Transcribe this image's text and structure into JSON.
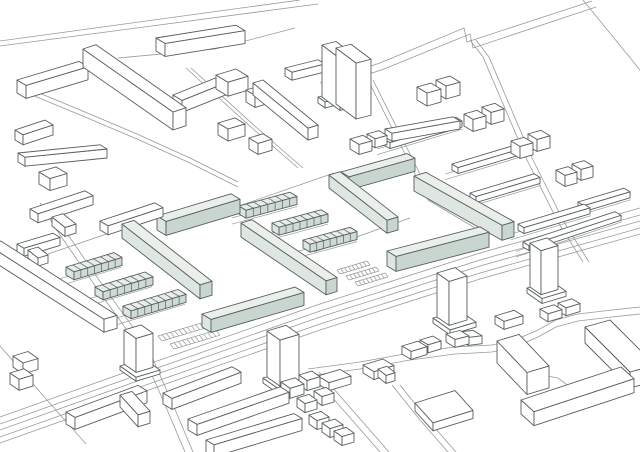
{
  "figure": {
    "kind": "axonometric-site-plan",
    "highlight_meaning": "proposed-buildings"
  },
  "palette": {
    "background": "#ffffff",
    "building_line": "#585e60",
    "road_line": "#969b9b",
    "white_face": "#ffffff",
    "green_top": "#eaefea",
    "green_end": "#dde6e0",
    "green_front": "#c9d6cf",
    "row_top": "#e8ede9",
    "row_end": "#dce5df",
    "row_front": "#cfdad3"
  },
  "scene": {
    "boxes": [
      [
        156,
        51,
        80,
        -0.16,
        9,
        0.6,
        13,
        "w"
      ],
      [
        83,
        67,
        13,
        -0.33,
        90,
        0.7,
        18,
        "w"
      ],
      [
        173,
        107,
        57,
        -0.4,
        9,
        0.6,
        12,
        "w"
      ],
      [
        216,
        89,
        20,
        -0.3,
        12,
        0.6,
        14,
        "w"
      ],
      [
        218,
        135,
        17,
        -0.3,
        10,
        0.6,
        12,
        "w"
      ],
      [
        246,
        102,
        15,
        -0.3,
        9,
        0.6,
        12,
        "w"
      ],
      [
        249,
        149,
        14,
        -0.3,
        9,
        0.6,
        11,
        "w"
      ],
      [
        253,
        95,
        10,
        -0.3,
        55,
        0.82,
        12,
        "w"
      ],
      [
        285,
        76,
        33,
        -0.25,
        7,
        0.6,
        8,
        "w"
      ],
      [
        318,
        103,
        8,
        -0.25,
        7,
        0.7,
        6,
        "w"
      ],
      [
        322,
        97,
        14,
        -0.25,
        18,
        0.75,
        52,
        "w"
      ],
      [
        336,
        104,
        15,
        -0.25,
        20,
        0.75,
        56,
        "w"
      ],
      [
        17,
        93,
        62,
        -0.3,
        9,
        0.6,
        13,
        "w"
      ],
      [
        15,
        140,
        30,
        -0.33,
        8,
        0.6,
        10,
        "w"
      ],
      [
        18,
        162,
        82,
        -0.1,
        7,
        0.6,
        9,
        "w"
      ],
      [
        39,
        184,
        17,
        -0.3,
        11,
        0.6,
        12,
        "w"
      ],
      [
        30,
        218,
        55,
        -0.33,
        8,
        0.6,
        9,
        "w"
      ],
      [
        52,
        226,
        11,
        -0.3,
        13,
        0.8,
        9,
        "w"
      ],
      [
        100,
        230,
        55,
        -0.33,
        8,
        0.6,
        9,
        "w"
      ],
      [
        124,
        238,
        11,
        -0.3,
        13,
        0.8,
        9,
        "w"
      ],
      [
        17,
        252,
        36,
        -0.3,
        7,
        0.6,
        8,
        "w"
      ],
      [
        28,
        258,
        10,
        -0.3,
        10,
        0.8,
        8,
        "w"
      ],
      [
        -12,
        258,
        13,
        -0.3,
        116,
        0.64,
        13,
        "w"
      ],
      [
        66,
        275,
        48,
        -0.3,
        8,
        0.6,
        8,
        "r",
        7,
        1
      ],
      [
        95,
        295,
        50,
        -0.3,
        8,
        0.6,
        8,
        "r",
        7,
        1
      ],
      [
        123,
        314,
        55,
        -0.3,
        8,
        0.6,
        8,
        "r",
        8,
        1
      ],
      [
        157,
        230,
        74,
        -0.3,
        9,
        0.6,
        14,
        "g"
      ],
      [
        122,
        238,
        12,
        -0.3,
        78,
        0.78,
        14,
        "g"
      ],
      [
        202,
        327,
        93,
        -0.29,
        9,
        0.6,
        13,
        "g"
      ],
      [
        241,
        237,
        11,
        -0.3,
        85,
        0.68,
        14,
        "g"
      ],
      [
        239,
        214,
        51,
        -0.27,
        7,
        0.6,
        8,
        "r",
        7,
        1
      ],
      [
        272,
        231,
        49,
        -0.27,
        7,
        0.6,
        8,
        "r",
        7,
        1
      ],
      [
        303,
        248,
        47,
        -0.27,
        7,
        0.6,
        8,
        "r",
        7,
        1
      ],
      [
        341,
        185,
        66,
        -0.28,
        8,
        0.6,
        13,
        "g"
      ],
      [
        329,
        188,
        11,
        -0.3,
        58,
        0.78,
        13,
        "g"
      ],
      [
        414,
        191,
        12,
        -0.3,
        88,
        0.56,
        15,
        "g"
      ],
      [
        387,
        266,
        93,
        -0.26,
        9,
        0.6,
        15,
        "g"
      ],
      [
        350,
        149,
        13,
        -0.28,
        9,
        0.6,
        10,
        "w"
      ],
      [
        367,
        143,
        12,
        -0.28,
        8,
        0.6,
        9,
        "w"
      ],
      [
        384,
        145,
        72,
        -0.3,
        6,
        0.6,
        6,
        "w",
        0,
        1
      ],
      [
        417,
        100,
        14,
        -0.28,
        10,
        0.6,
        13,
        "w"
      ],
      [
        436,
        93,
        14,
        -0.28,
        10,
        0.6,
        13,
        "w"
      ],
      [
        452,
        170,
        66,
        -0.3,
        6,
        0.6,
        6,
        "w",
        0,
        1
      ],
      [
        464,
        126,
        13,
        -0.28,
        9,
        0.6,
        12,
        "w"
      ],
      [
        482,
        119,
        13,
        -0.28,
        9,
        0.6,
        12,
        "w"
      ],
      [
        470,
        199,
        64,
        -0.3,
        6,
        0.6,
        6,
        "w",
        0,
        1
      ],
      [
        511,
        153,
        13,
        -0.28,
        9,
        0.6,
        12,
        "w"
      ],
      [
        528,
        146,
        13,
        -0.28,
        9,
        0.6,
        12,
        "w"
      ],
      [
        518,
        230,
        66,
        -0.3,
        6,
        0.6,
        6,
        "w",
        0,
        1
      ],
      [
        556,
        181,
        12,
        -0.28,
        9,
        0.6,
        11,
        "w"
      ],
      [
        572,
        175,
        12,
        -0.28,
        9,
        0.6,
        11,
        "w"
      ],
      [
        578,
        208,
        46,
        -0.3,
        6,
        0.6,
        6,
        "w",
        0,
        1
      ],
      [
        523,
        247,
        92,
        -0.33,
        6,
        0.6,
        5,
        "w",
        0,
        1
      ],
      [
        385,
        137,
        68,
        -0.18,
        7,
        0.6,
        8,
        "w"
      ],
      [
        120,
        370,
        24,
        -0.3,
        16,
        0.7,
        4,
        "w",
        0,
        0,
        355
      ],
      [
        124,
        364,
        17,
        -0.3,
        12,
        0.7,
        34,
        "w"
      ],
      [
        66,
        424,
        72,
        -0.37,
        9,
        0.6,
        12,
        "w"
      ],
      [
        120,
        407,
        12,
        -0.3,
        18,
        1.1,
        12,
        "w"
      ],
      [
        13,
        367,
        15,
        -0.3,
        10,
        0.7,
        11,
        "w"
      ],
      [
        10,
        384,
        14,
        -0.3,
        9,
        0.7,
        11,
        "w"
      ],
      [
        163,
        404,
        69,
        -0.38,
        9,
        0.6,
        11,
        "w"
      ],
      [
        188,
        430,
        92,
        -0.35,
        9,
        0.6,
        11,
        "w"
      ],
      [
        206,
        452,
        88,
        -0.3,
        8,
        0.6,
        12,
        "w"
      ],
      [
        263,
        383,
        27,
        -0.3,
        18,
        0.7,
        5,
        "w",
        0,
        0,
        368
      ],
      [
        267,
        377,
        19,
        -0.3,
        13,
        0.7,
        46,
        "w"
      ],
      [
        281,
        392,
        14,
        -0.3,
        9,
        0.7,
        10,
        "w"
      ],
      [
        299,
        385,
        13,
        -0.3,
        8,
        0.7,
        10,
        "w"
      ],
      [
        297,
        407,
        12,
        -0.3,
        8,
        0.7,
        9,
        "w"
      ],
      [
        314,
        400,
        12,
        -0.3,
        8,
        0.7,
        9,
        "w"
      ],
      [
        309,
        424,
        12,
        -0.3,
        8,
        0.7,
        9,
        "w"
      ],
      [
        322,
        432,
        13,
        -0.3,
        8,
        0.7,
        9,
        "w"
      ],
      [
        334,
        440,
        12,
        -0.3,
        8,
        0.7,
        9,
        "w"
      ],
      [
        433,
        323,
        26,
        -0.3,
        17,
        0.7,
        5,
        "w",
        0,
        0,
        308
      ],
      [
        437,
        317,
        18,
        -0.3,
        12,
        0.7,
        44,
        "w"
      ],
      [
        527,
        293,
        24,
        -0.3,
        15,
        0.7,
        5,
        "w",
        0,
        0,
        278
      ],
      [
        530,
        287,
        17,
        -0.3,
        11,
        0.7,
        44,
        "w"
      ],
      [
        318,
        384,
        22,
        -0.3,
        11,
        0.6,
        8,
        "w"
      ],
      [
        363,
        373,
        20,
        -0.3,
        11,
        0.6,
        8,
        "w"
      ],
      [
        378,
        377,
        9,
        -0.3,
        8,
        0.8,
        8,
        "w"
      ],
      [
        402,
        354,
        16,
        -0.3,
        9,
        0.6,
        8,
        "w"
      ],
      [
        420,
        348,
        13,
        -0.3,
        8,
        0.6,
        8,
        "w"
      ],
      [
        446,
        342,
        14,
        -0.25,
        9,
        0.6,
        8,
        "w"
      ],
      [
        459,
        340,
        14,
        -0.12,
        9,
        0.6,
        8,
        "w"
      ],
      [
        495,
        324,
        19,
        -0.3,
        9,
        0.6,
        8,
        "w"
      ],
      [
        540,
        317,
        14,
        -0.3,
        8,
        0.6,
        8,
        "w"
      ],
      [
        558,
        311,
        14,
        -0.3,
        8,
        0.6,
        8,
        "w"
      ],
      [
        415,
        411,
        40,
        -0.31,
        18,
        1.1,
        8,
        "w"
      ],
      [
        497,
        363,
        22,
        -0.3,
        30,
        1.05,
        22,
        "w"
      ],
      [
        521,
        414,
        100,
        -0.33,
        13,
        0.9,
        14,
        "w"
      ],
      [
        585,
        343,
        25,
        -0.28,
        45,
        1.0,
        16,
        "w"
      ]
    ],
    "roads": [
      {
        "pts": [
          [
            0,
            46
          ],
          [
            318,
            4
          ]
        ]
      },
      {
        "pts": [
          [
            0,
            41
          ],
          [
            300,
            0
          ]
        ]
      },
      {
        "pts": [
          [
            320,
            83
          ],
          [
            380,
            63
          ],
          [
            464,
            28
          ],
          [
            467,
            42
          ],
          [
            574,
            7
          ],
          [
            592,
            1
          ]
        ]
      },
      {
        "pts": [
          [
            324,
            89
          ],
          [
            384,
            69
          ],
          [
            470,
            34
          ],
          [
            473,
            48
          ],
          [
            578,
            13
          ],
          [
            596,
            7
          ]
        ]
      },
      {
        "pts": [
          [
            583,
            0
          ],
          [
            640,
            70
          ]
        ]
      },
      {
        "pts": [
          [
            0,
            430
          ],
          [
            160,
            373
          ],
          [
            320,
            317
          ],
          [
            480,
            266
          ],
          [
            640,
            221
          ]
        ],
        "oy": [
          -13,
          -6,
          0,
          7,
          13
        ]
      },
      {
        "pts": [
          [
            40,
            203
          ],
          [
            58,
            232
          ],
          [
            98,
            290
          ],
          [
            140,
            348
          ],
          [
            163,
            400
          ],
          [
            185,
            452
          ]
        ],
        "ox": [
          0,
          8
        ]
      },
      {
        "pts": [
          [
            20,
            85
          ],
          [
            85,
            112
          ],
          [
            137,
            134
          ],
          [
            190,
            158
          ],
          [
            238,
            182
          ]
        ],
        "oy": [
          0,
          5
        ]
      },
      {
        "pts": [
          [
            186,
            68
          ],
          [
            252,
            128
          ],
          [
            298,
            168
          ]
        ],
        "ox": [
          0,
          5
        ]
      },
      {
        "pts": [
          [
            470,
            40
          ],
          [
            483,
            57
          ],
          [
            527,
            160
          ],
          [
            558,
            222
          ],
          [
            583,
            262
          ]
        ],
        "ox": [
          0,
          6
        ]
      },
      {
        "pts": [
          [
            368,
            80
          ],
          [
            402,
            148
          ],
          [
            428,
            200
          ]
        ],
        "ox": [
          0,
          5
        ]
      },
      {
        "pts": [
          [
            118,
            58
          ],
          [
            215,
            49
          ],
          [
            295,
            28
          ]
        ]
      },
      {
        "pts": [
          [
            236,
            207
          ],
          [
            334,
            173
          ]
        ]
      },
      {
        "pts": [
          [
            314,
            252
          ],
          [
            410,
            218
          ]
        ]
      },
      {
        "pts": [
          [
            428,
            200
          ],
          [
            482,
            232
          ]
        ]
      },
      {
        "pts": [
          [
            412,
            258
          ],
          [
            480,
            233
          ]
        ]
      },
      {
        "pts": [
          [
            48,
            254
          ],
          [
            130,
            226
          ]
        ]
      },
      {
        "pts": [
          [
            310,
            372
          ],
          [
            345,
            412
          ],
          [
            380,
            452
          ]
        ],
        "ox": [
          0,
          9
        ]
      },
      {
        "pts": [
          [
            392,
            385
          ],
          [
            420,
            420
          ],
          [
            448,
            452
          ]
        ],
        "ox": [
          0,
          8
        ]
      },
      {
        "pts": [
          [
            612,
            332
          ],
          [
            640,
            366
          ]
        ],
        "ox": [
          0,
          7
        ]
      },
      {
        "pts": [
          [
            308,
            369
          ],
          [
            360,
            362
          ],
          [
            410,
            353
          ],
          [
            455,
            347
          ],
          [
            492,
            345
          ],
          [
            515,
            340
          ],
          [
            538,
            330
          ],
          [
            556,
            320
          ],
          [
            578,
            314
          ],
          [
            612,
            310
          ],
          [
            640,
            307
          ]
        ],
        "oy": [
          0,
          7
        ]
      },
      {
        "pts": [
          [
            0,
            346
          ],
          [
            40,
            392
          ],
          [
            86,
            444
          ]
        ]
      },
      {
        "pts": [
          [
            531,
            385
          ],
          [
            537,
            379
          ],
          [
            547,
            376
          ],
          [
            558,
            378
          ],
          [
            566,
            384
          ],
          [
            569,
            390
          ]
        ]
      }
    ],
    "hatches": [
      {
        "o": [
          158,
          336
        ],
        "u": 46,
        "us": -0.3,
        "rows": 2,
        "gap": [
          12,
          8
        ],
        "ticks": 11,
        "tick": [
          4,
          5
        ]
      },
      {
        "o": [
          337,
          270
        ],
        "u": 30,
        "us": -0.3,
        "rows": 3,
        "gap": [
          9,
          6
        ],
        "ticks": 8,
        "tick": [
          3,
          4
        ]
      }
    ]
  }
}
